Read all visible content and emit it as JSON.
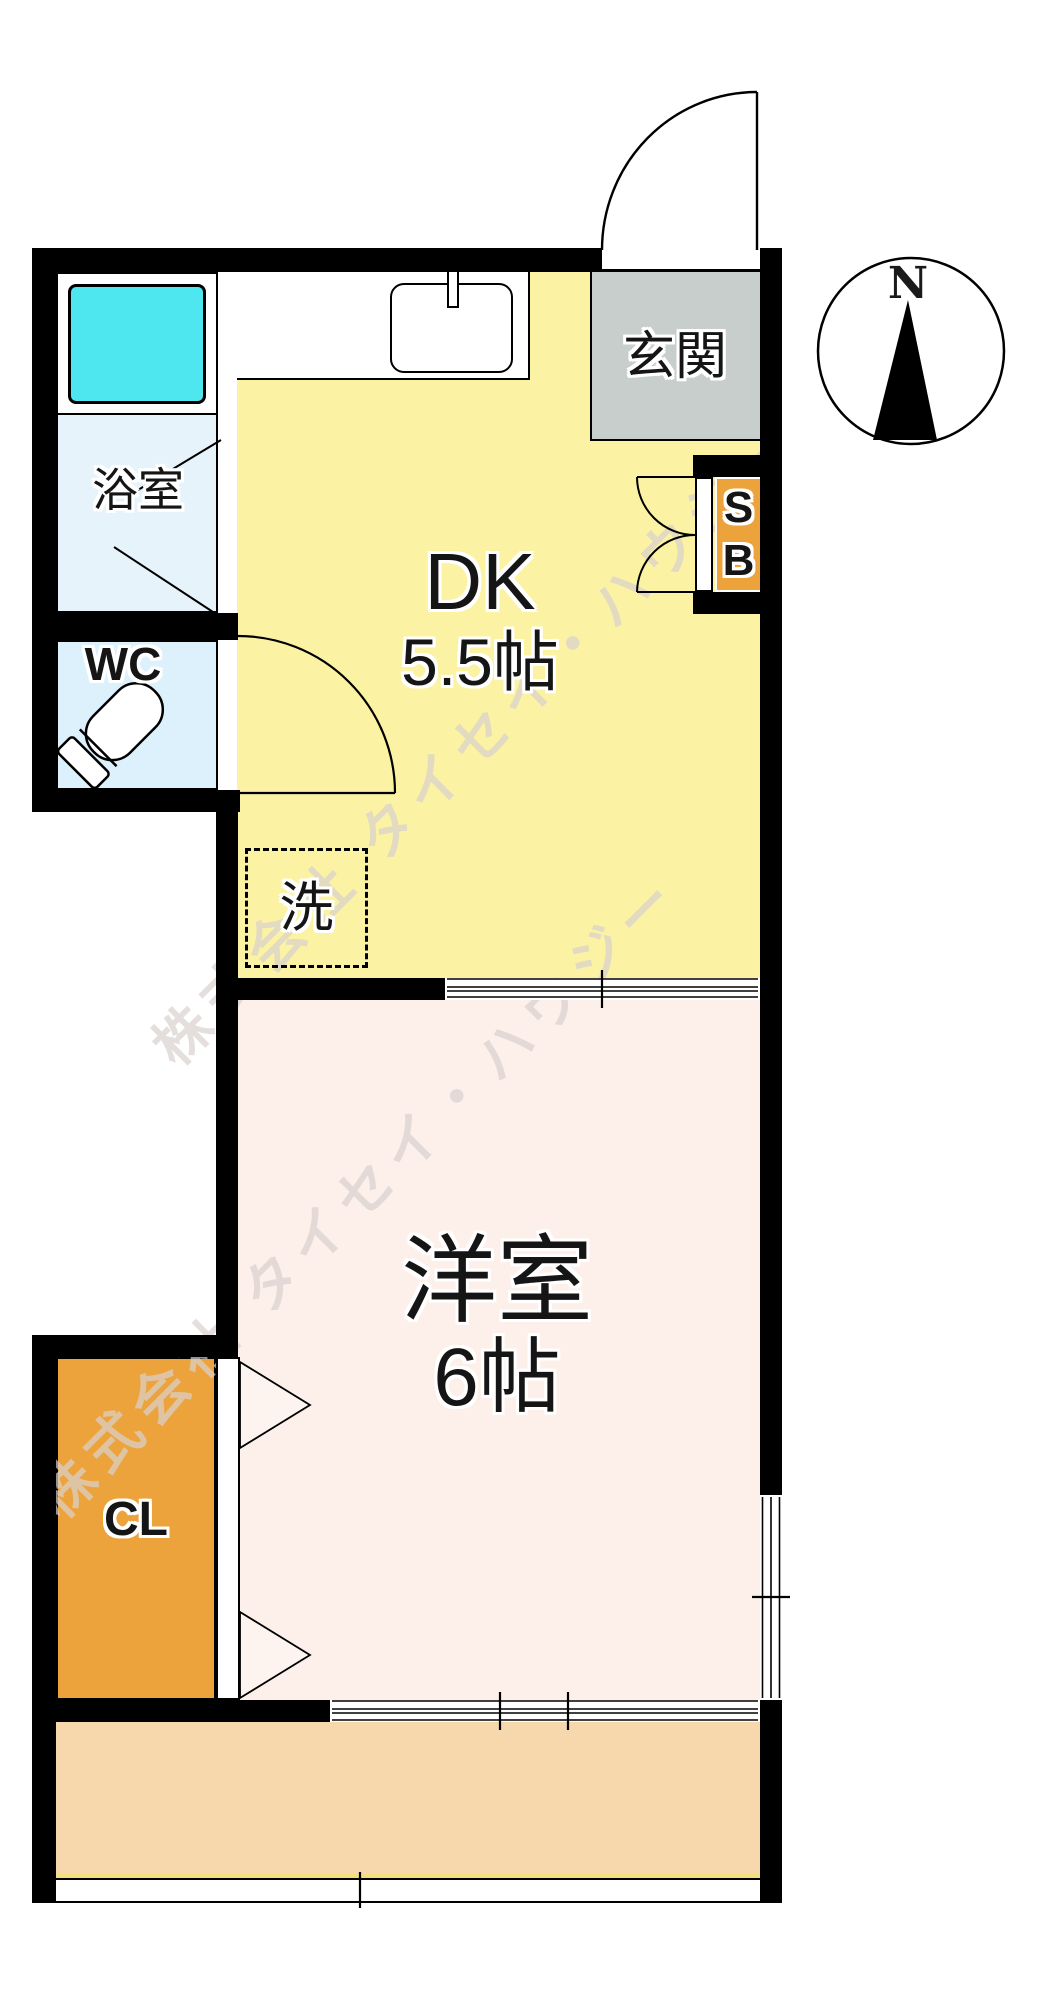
{
  "compass": {
    "north_label": "N"
  },
  "watermark": {
    "text": "株式会社 タイセイ・ハウジー"
  },
  "rooms": {
    "genkan": {
      "label": "玄関"
    },
    "dk": {
      "label": "DK",
      "size": "5.5帖"
    },
    "bathroom": {
      "label": "浴室"
    },
    "wc": {
      "label": "WC"
    },
    "laundry": {
      "label": "洗"
    },
    "western": {
      "label": "洋室",
      "size": "6帖"
    },
    "closet": {
      "label": "CL"
    },
    "shoebox": {
      "top": "S",
      "bottom": "B"
    }
  },
  "colors": {
    "wall": "#000000",
    "dk_floor": "#fbf3a3",
    "western_floor": "#fdf0ea",
    "balcony_floor": "#f7d7ac",
    "genkan_floor": "#c7cecb",
    "closet_fill": "#eda33c",
    "shoebox_fill": "#eda33c",
    "bathtub_fill": "#4ee7f0",
    "bathroom_floor": "#e7f3fb",
    "wc_floor": "#ddf1fc"
  }
}
